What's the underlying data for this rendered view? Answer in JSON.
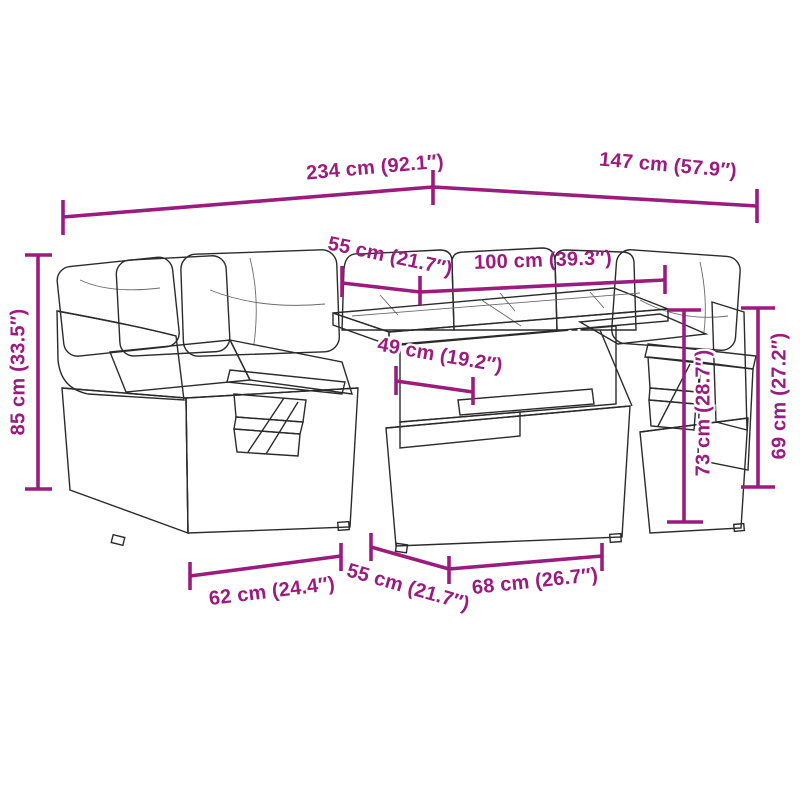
{
  "figure": {
    "illustration": "rattan-garden-sofa-set-with-table-line-drawing",
    "background": "#ffffff"
  },
  "colors": {
    "dimension_magenta": "#9B1B7E",
    "outline_dark": "#2b2b2b",
    "weave_gray": "#6e6e6e",
    "cushion_white": "#ffffff"
  },
  "dimensions": [
    {
      "id": "total-width",
      "label": "234 cm (92.1″)"
    },
    {
      "id": "total-depth",
      "label": "147 cm (57.9″)"
    },
    {
      "id": "table-depth-top",
      "label": "55 cm (21.7″)"
    },
    {
      "id": "table-width",
      "label": "100 cm (39.3″)"
    },
    {
      "id": "shelf-clearance",
      "label": "49 cm (19.2″)"
    },
    {
      "id": "back-height",
      "label": "85 cm (33.5″)"
    },
    {
      "id": "table-height",
      "label": "73 cm (28.7″)"
    },
    {
      "id": "arm-height",
      "label": "69 cm (27.2″)"
    },
    {
      "id": "seat-width",
      "label": "62 cm (24.4″)"
    },
    {
      "id": "seat-depth",
      "label": "55 cm (21.7″)"
    },
    {
      "id": "base-width",
      "label": "68 cm (26.7″)"
    }
  ]
}
